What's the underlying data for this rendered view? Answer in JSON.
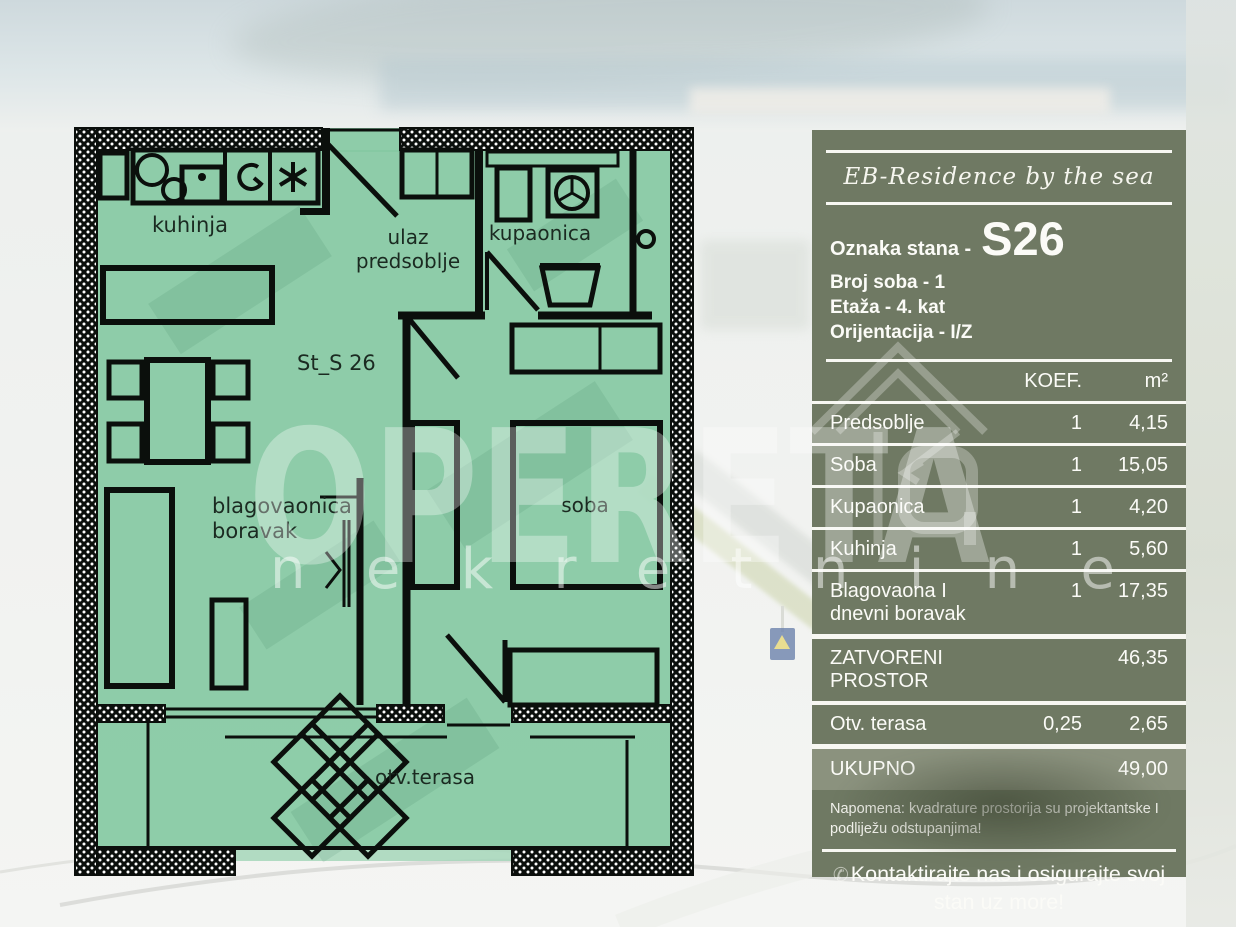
{
  "floor_plan": {
    "plan_id": "St_S 26",
    "labels": {
      "kuhinja": "kuhinja",
      "ulaz1": "ulaz",
      "ulaz2": "predsoblje",
      "kupaonica": "kupaonica",
      "blag1": "blagovaonica",
      "blag2": "boravak",
      "soba": "soba",
      "terasa": "otv.terasa"
    },
    "colors": {
      "interior_green": "#85c9a3",
      "wall_black": "#0b0f0c"
    }
  },
  "watermark": {
    "brand": "OPERETA",
    "sub": "nekretnine"
  },
  "panel": {
    "brand_script": "EB-Residence by the sea",
    "unit_label": "Oznaka stana -",
    "unit_value": "S26",
    "info_lines": [
      "Broj soba - 1",
      "Etaža - 4. kat",
      "Orijentacija - I/Z"
    ],
    "table": {
      "headers": {
        "koef": "KOEF.",
        "area": "m²"
      },
      "rows": [
        {
          "label": "Predsoblje",
          "koef": "1",
          "area": "4,15"
        },
        {
          "label": "Soba",
          "koef": "1",
          "area": "15,05"
        },
        {
          "label": "Kupaonica",
          "koef": "1",
          "area": "4,20"
        },
        {
          "label": "Kuhinja",
          "koef": "1",
          "area": "5,60"
        },
        {
          "label": "Blagovaona I dnevni boravak",
          "koef": "1",
          "area": "17,35"
        },
        {
          "label": "ZATVORENI PROSTOR",
          "koef": "",
          "area": "46,35"
        },
        {
          "label": "Otv. terasa",
          "koef": "0,25",
          "area": "2,65"
        }
      ],
      "total": {
        "label": "UKUPNO",
        "koef": "",
        "area": "49,00"
      }
    },
    "note": "Napomena: kvadrature prostorija su projektantske I podliježu odstupanjima!",
    "phone_icon": "✆",
    "cta": "Kontaktirajte nas i osigurajte svoj stan uz more!",
    "colors": {
      "panel_bg": "#6f7963",
      "total_row_bg": "#8b927e",
      "line": "#f7f7f2"
    }
  }
}
